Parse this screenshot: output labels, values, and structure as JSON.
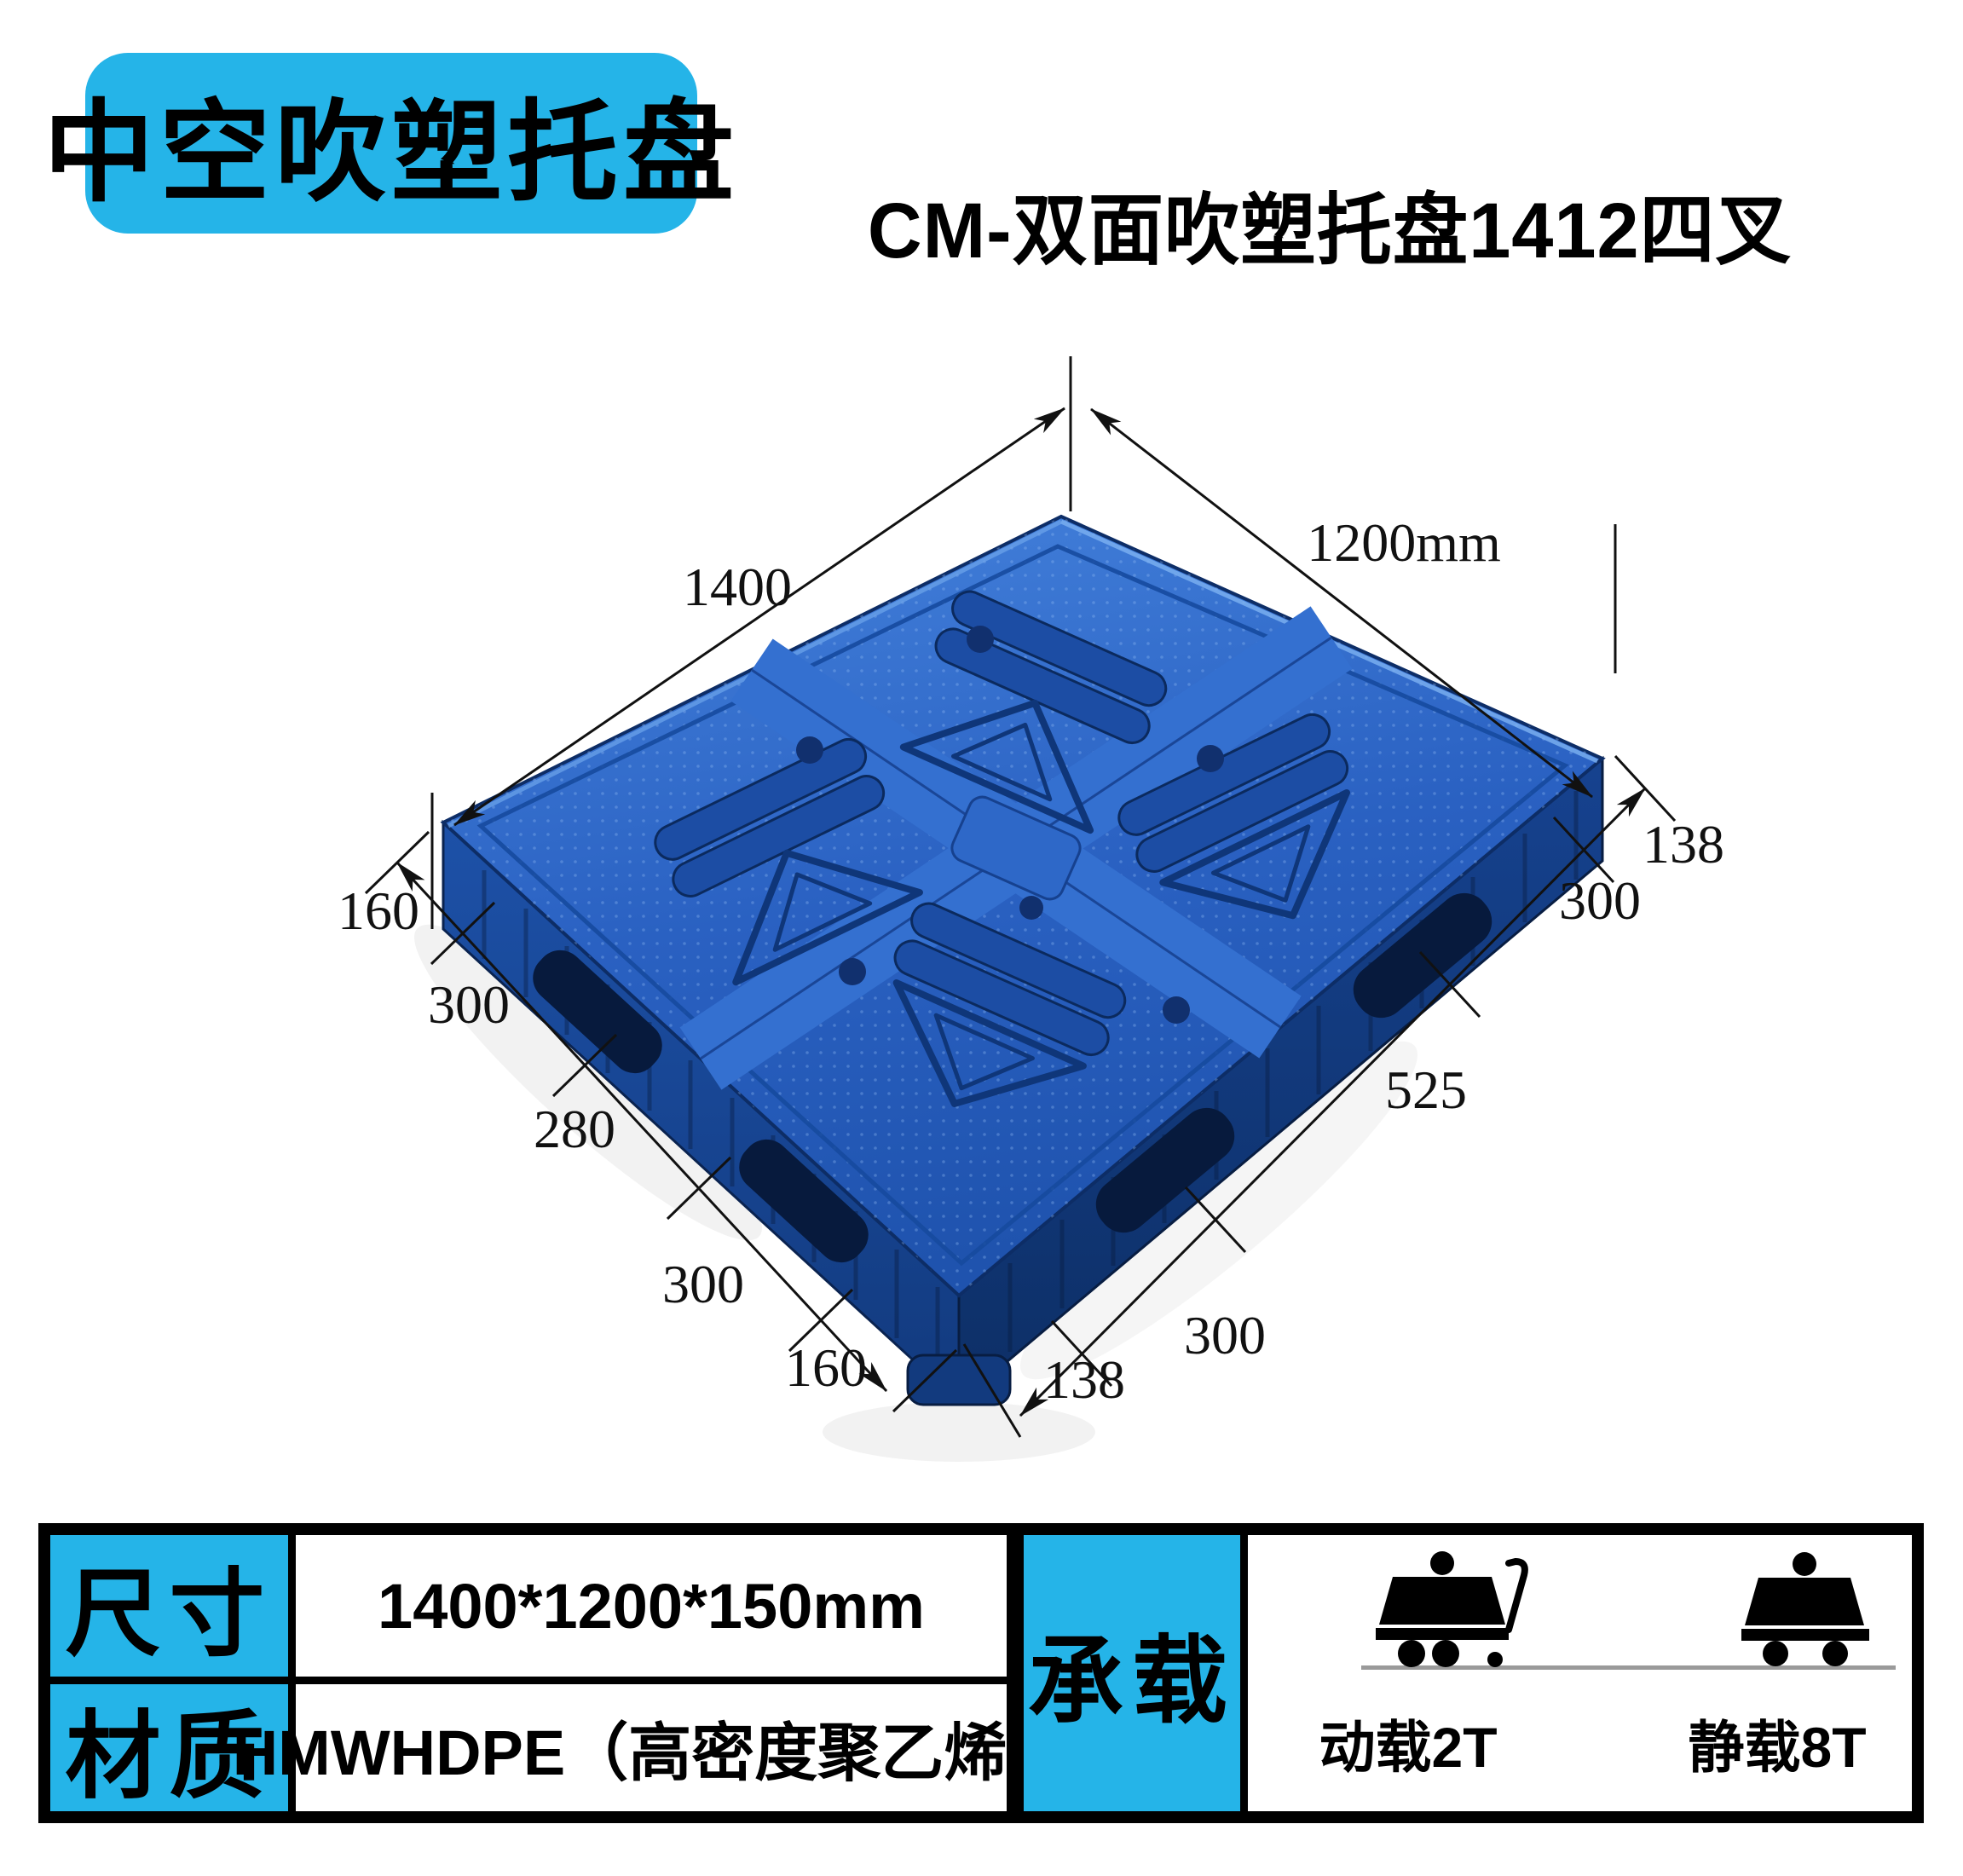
{
  "badge": {
    "text": "中空吹塑托盘"
  },
  "title": {
    "text": "CM-双面吹塑托盘1412四叉"
  },
  "diagram": {
    "width_label": "1400",
    "depth_label": "1200mm",
    "right_chain": [
      "138",
      "300",
      "525",
      "300",
      "138"
    ],
    "left_chain": [
      "160",
      "300",
      "280",
      "300",
      "160"
    ]
  },
  "table": {
    "rows": [
      {
        "label": "尺寸",
        "value": "1400*1200*150mm"
      },
      {
        "label": "材质",
        "value": "HMWHDPE（高密度聚乙烯）"
      }
    ],
    "load": {
      "label": "承载",
      "dynamic_label": "动载2T",
      "static_label": "静载8T"
    }
  },
  "colors": {
    "accent_cyan": "#25B4E8",
    "pallet_blue": "#2A64C4",
    "pallet_shadow": "#0C2A60",
    "pallet_highlight": "#4F8ADE"
  }
}
